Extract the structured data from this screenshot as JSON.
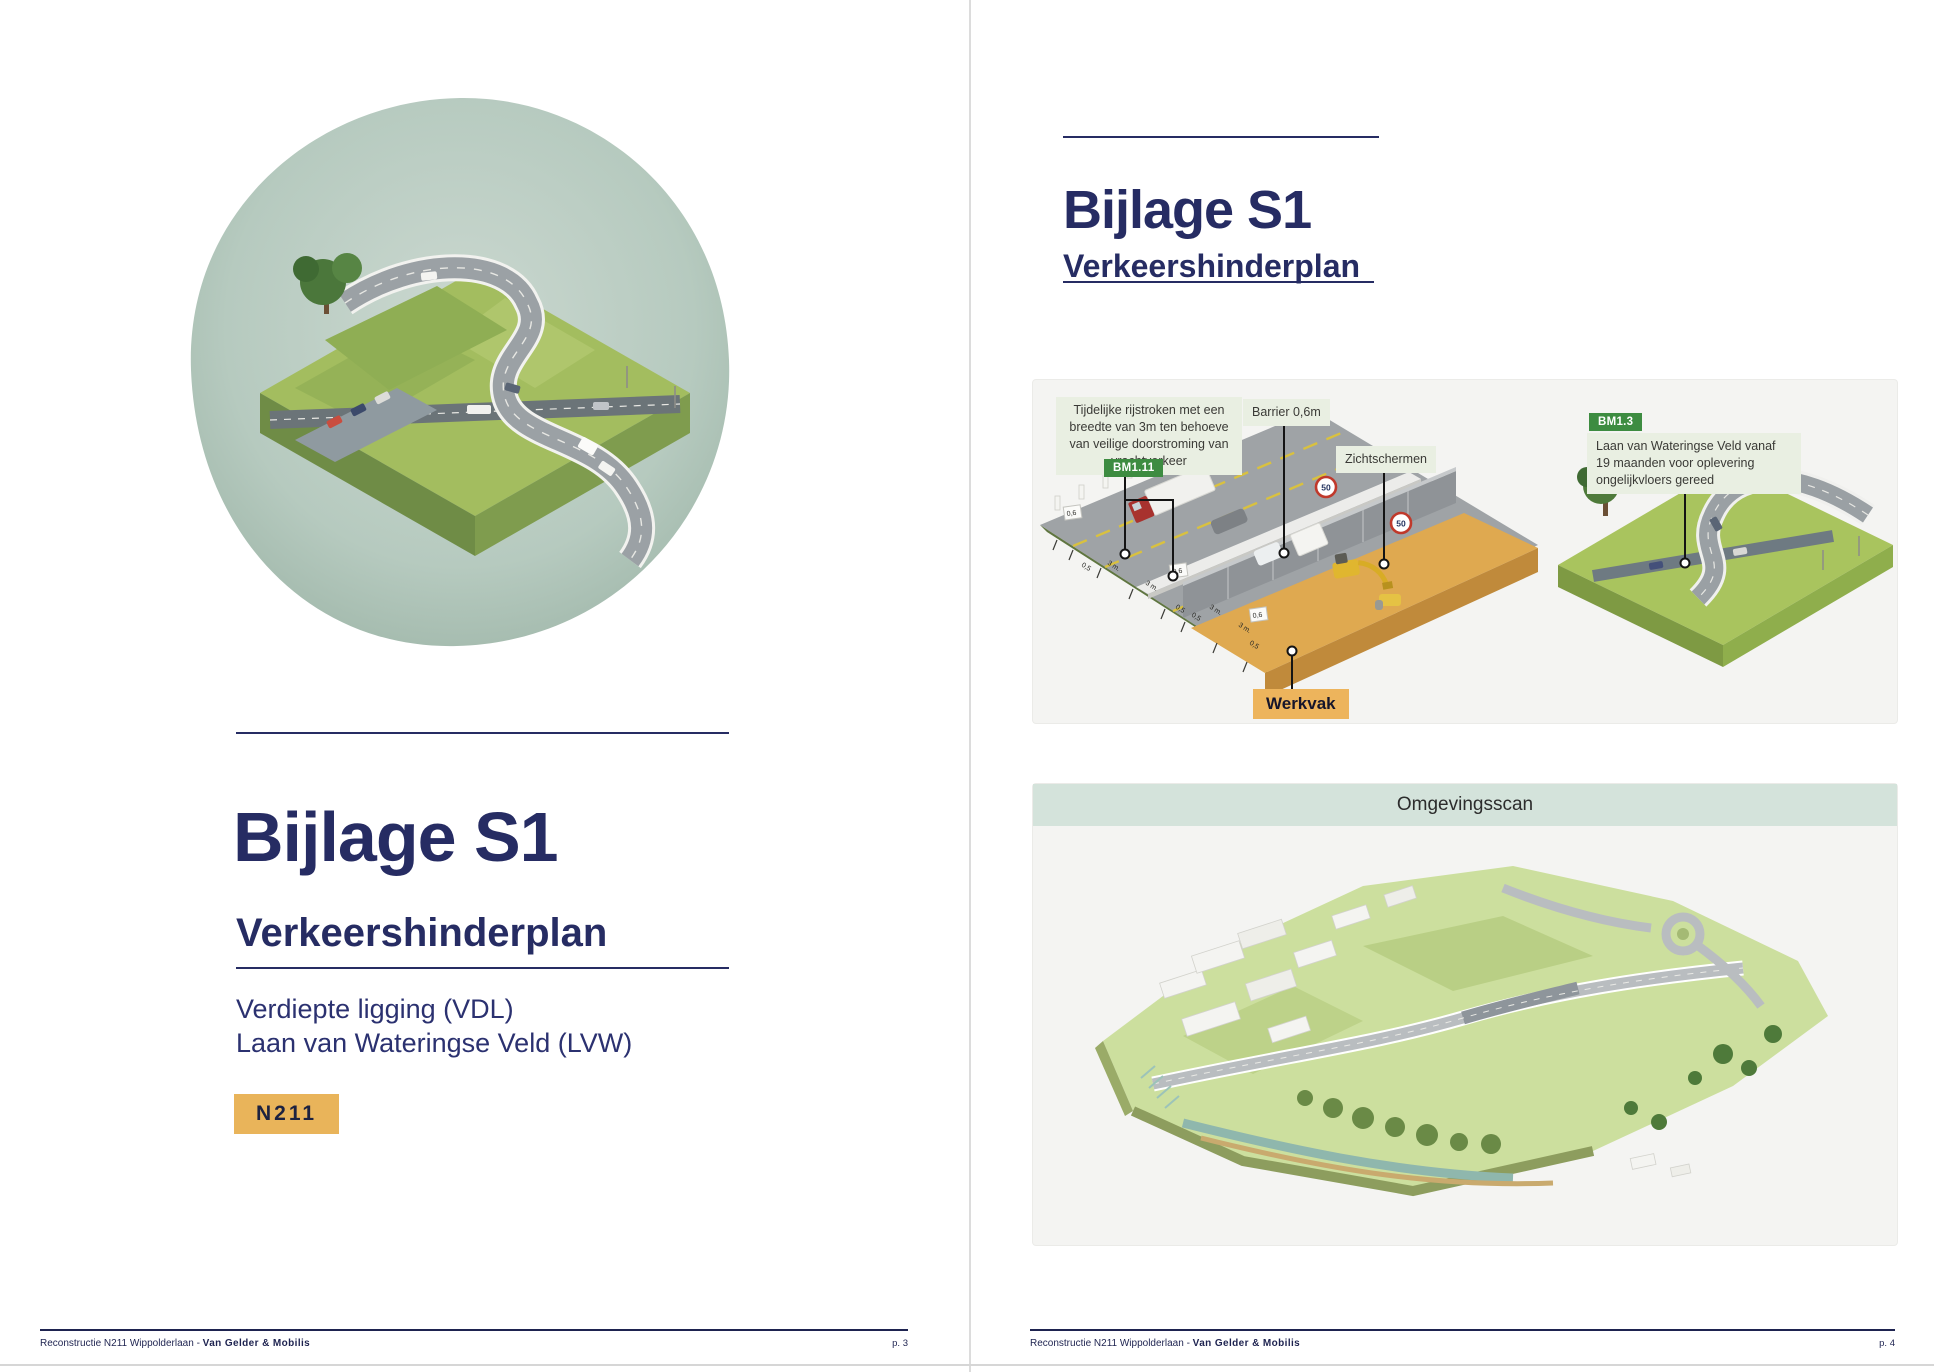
{
  "colors": {
    "navy": "#262c63",
    "amber": "#e9b45a",
    "badge_green": "#3d8c41",
    "annotation_bg": "#e9efe2",
    "panel_bg": "#f4f4f2",
    "scan_band_bg": "#d4e3db",
    "blob": "#b3c9bd"
  },
  "page_left": {
    "title": "Bijlage S1",
    "subtitle": "Verkeershinderplan",
    "line1": "Verdiepte ligging (VDL)",
    "line2": "Laan van Wateringse Veld (LVW)",
    "badge": "N211",
    "footer": {
      "project": "Reconstructie N211 Wippolderlaan - ",
      "company": "Van Gelder & Mobilis",
      "page": "p. 3"
    }
  },
  "page_right": {
    "title": "Bijlage S1",
    "subtitle": "Verkeershinderplan",
    "figure1": {
      "label_lanes_lines": {
        "l1": "Tijdelijke rijstroken met een",
        "l2": "breedte van 3m ten behoeve",
        "l3": "van veilige doorstroming van",
        "l4": "vrachtverkeer"
      },
      "badge_bm111": "BM1.11",
      "label_barrier": "Barrier 0,6m",
      "label_zichtschermen": "Zichtschermen",
      "label_werkvak": "Werkvak",
      "badge_bm13": "BM1.3",
      "bm13_lines": {
        "l1": "Laan van Wateringse Veld  vanaf",
        "l2": "19 maanden voor oplevering",
        "l3": "ongelijkvloers gereed"
      },
      "speed_sign": "50",
      "measurements": {
        "m1": "0,6",
        "m2": "0,5",
        "m3": "3 m.",
        "m4": "3 m.",
        "m5": "0,6",
        "m6": "0,5",
        "m7": "0,5",
        "m8": "3 m.",
        "m9": "3 m.",
        "m10": "0,6",
        "m11": "0,5"
      }
    },
    "figure2": {
      "title": "Omgevingsscan"
    },
    "footer": {
      "project": "Reconstructie N211 Wippolderlaan - ",
      "company": "Van Gelder & Mobilis",
      "page": "p. 4"
    }
  }
}
